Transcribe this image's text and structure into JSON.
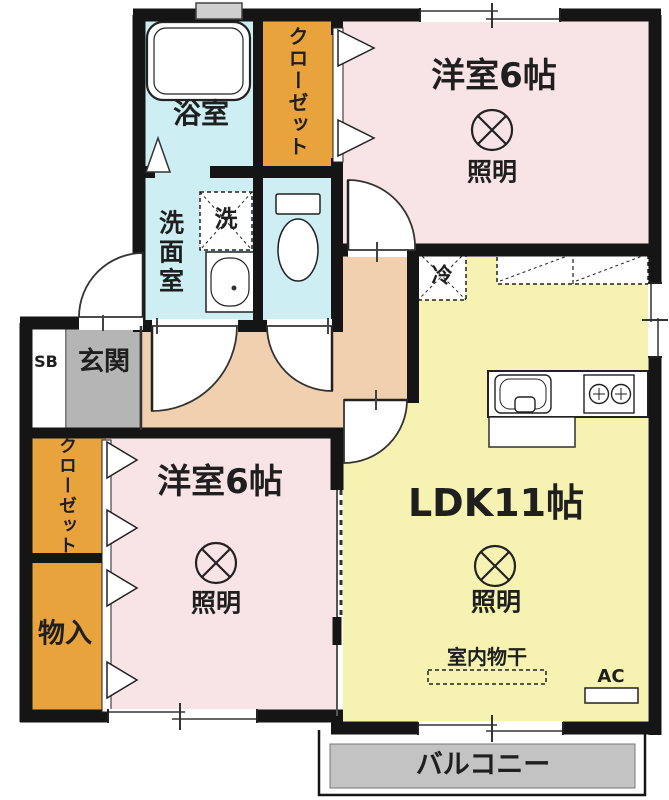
{
  "title": "apartment-floorplan",
  "colors": {
    "wall": "#151515",
    "bedroom_pink": "#f8e4e6",
    "ldk_yellow": "#f6f3b2",
    "wet_area_blue": "#cdeef2",
    "closet_orange": "#e8a33c",
    "corridor_beige": "#f0d0ae",
    "entrance_gray": "#b5b5b5",
    "balcony_gray": "#c3c3c3"
  },
  "rooms": {
    "bedroom_top": {
      "name": "洋室6帖",
      "light": "照明"
    },
    "bedroom_left": {
      "name": "洋室6帖",
      "light": "照明"
    },
    "ldk": {
      "name": "LDK11帖",
      "light": "照明"
    },
    "bathroom": {
      "name": "浴室"
    },
    "washroom": {
      "name": "洗面室"
    },
    "entrance": {
      "name": "玄関",
      "shoe_box": "SB"
    },
    "closet_top": {
      "name": "クローゼット"
    },
    "closet_left": {
      "name": "クローゼット"
    },
    "storage": {
      "name": "物入"
    },
    "balcony": {
      "name": "バルコニー"
    }
  },
  "fixtures": {
    "washer": "洗",
    "fridge": "冷",
    "indoor_drying": "室内物干",
    "ac": "AC"
  }
}
